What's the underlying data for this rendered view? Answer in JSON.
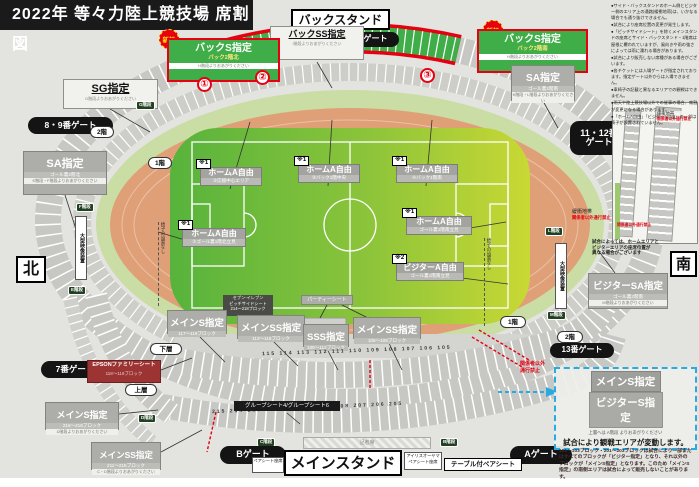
{
  "title": "2022年 等々力陸上競技場 席割図",
  "compass": {
    "north": "北",
    "south": "南"
  },
  "stand_titles": {
    "back": "バックスタンド",
    "main": "メインスタンド"
  },
  "gates": {
    "g7": "7番ゲート",
    "g89": "8・9番ゲート",
    "g10": "10番ゲート",
    "g1112": "11・12番\nゲート",
    "g13": "13番ゲート",
    "ga": "Aゲート",
    "gb": "Bゲート"
  },
  "floors": {
    "f1": "1階",
    "f2": "2階",
    "lower": "下層",
    "upper": "上層"
  },
  "stairs": {
    "b": "B階段",
    "c": "C階段",
    "d": "D階段",
    "e": "E階段",
    "f": "F階段",
    "g": "G階段",
    "l": "L階段",
    "m": "M階段"
  },
  "new_badge": "新設",
  "zone_numbers": [
    "①",
    "②",
    "③"
  ],
  "back_s_north": {
    "title": "バックS指定",
    "sub": "バック2階北",
    "stairs": "H階段よりおあがりください"
  },
  "back_s_south": {
    "title": "バックS指定",
    "sub": "バック2階南",
    "stairs": "H階段よりおあがりください"
  },
  "back_ss": {
    "title": "バックSS指定",
    "stairs": "I階段よりおあがりください"
  },
  "sg": {
    "title": "SG指定",
    "stairs": "G階段よりおあがりください"
  },
  "sa_north": {
    "title": "SA指定",
    "sub": "ゴール裏2階北",
    "stairs": "E階段・F階段よりおあがりください"
  },
  "sa_south": {
    "title": "SA指定",
    "sub": "ゴール裏2階南",
    "stairs": "K階段・L階段よりおあがりください"
  },
  "visitor_sa": {
    "title": "ビジターSA指定",
    "sub": "ゴール裏2階南",
    "stairs": "M階段よりおあがりください"
  },
  "field_labels": [
    {
      "mark": "※1",
      "title": "ホームA自由",
      "sub": "①ゴール裏1階北立見"
    },
    {
      "mark": "※1",
      "title": "ホームA自由",
      "sub": "②応援中心エリア"
    },
    {
      "mark": "※1",
      "title": "ホームA自由",
      "sub": "③バック1階中央"
    },
    {
      "mark": "※1",
      "title": "ホームA自由",
      "sub": "④バック1階南"
    },
    {
      "mark": "※1",
      "title": "ホームA自由",
      "sub": "ゴール裏1階南立見"
    },
    {
      "mark": "※2",
      "title": "ビジターA自由",
      "sub": "ゴール裏1階南立見"
    }
  ],
  "main_labels": [
    {
      "title": "メインS指定",
      "sub": "117〜119ブロック"
    },
    {
      "title": "メインSS指定",
      "sub": "113〜116ブロック"
    },
    {
      "title": "SSS指定",
      "sub": "109〜112ブロック"
    },
    {
      "title": "メインSS指定",
      "sub": "105〜108ブロック"
    }
  ],
  "lower_labels": {
    "family": {
      "title": "EPSONファミリーシート",
      "sub": "118〜119ブロック"
    },
    "main_s2": {
      "title": "メインS指定",
      "sub": "216〜218ブロック",
      "stairs": "D階段よりおあがりください"
    },
    "main_ss2": {
      "title": "メインSS指定",
      "sub": "211〜215ブロック",
      "stairs": "C・D階段よりおあがりください"
    },
    "group": "グループシート4/グループシート6",
    "pair": "ペアシート座席",
    "iris": "アイリスオーヤマ ペアシート座席",
    "table_pair": "テーブル付ペアシート",
    "press": "記者席",
    "party": "パーティーシート",
    "pitchside": {
      "l1": "セブン-イレブン",
      "l2": "ピッチサイドシート",
      "l3": "214〜218ブロック"
    }
  },
  "buffer": {
    "label": "緩衝地帯",
    "warn": "関係者以外通行禁止"
  },
  "no_entry": "関係者以外\n通行禁止",
  "screen": "大型映像装置",
  "no_chairs": "椅子の設置なし",
  "inset_note": "試合によっては、ホームエリアと\nビジターエリアの座席位置が\n異なる場合がございます",
  "variable_box": {
    "h1": "メインS指定",
    "h2": "ビジターS指定",
    "stairs": "上層へは A階段 よりおあがりください",
    "headline": "試合により観戦エリアが変動します。",
    "body": "101〜103ブロック・201〜203ブロックは試合により一部またはすべてのブロックが「ビジター指定」となり、それ以外のブロックが「メインS指定」となります。このため「メインS指定」の南側エリアは試合によって販売しないことがあります。"
  },
  "notes": [
    "●サイド・バックスタンドのホーム側とビジター側のエリア上の通路(緩衝地帯)は、いかなる場合でも通り抜けできません。",
    "●試合により座席位置の変更が発生します。",
    "●「ピッチサイドシート」を除くメインスタンドの座席とサイド・バックスタンド・1階席は屋根に覆われていますが、風向きや雨の強さによっては雨に濡れる場合があります。",
    "●試合により販売しない席種がある場合がございます。",
    "●各チケットには入場ゲートが指定されております。指定ゲート以外からは入場できません。",
    "●車椅子の記載と異なるエリアでの観戦はできません。",
    "●雨天や陸上競技場以外での催事の場合、席割が変更になる場合があります。",
    "●「ホームA自由」「ビジターA自由」の一部は椅子が設置されていません。"
  ],
  "block_numbers_upper": "115 114 113 112 111 110 109 108 107 106 105",
  "block_numbers_lower": "215 214 213 212 211 210 209 208 207 206 205",
  "colors": {
    "accent_red": "#e60012",
    "new_zone_green": "#3fae49",
    "track": "#e0a077",
    "info_cyan": "#29abe2"
  }
}
